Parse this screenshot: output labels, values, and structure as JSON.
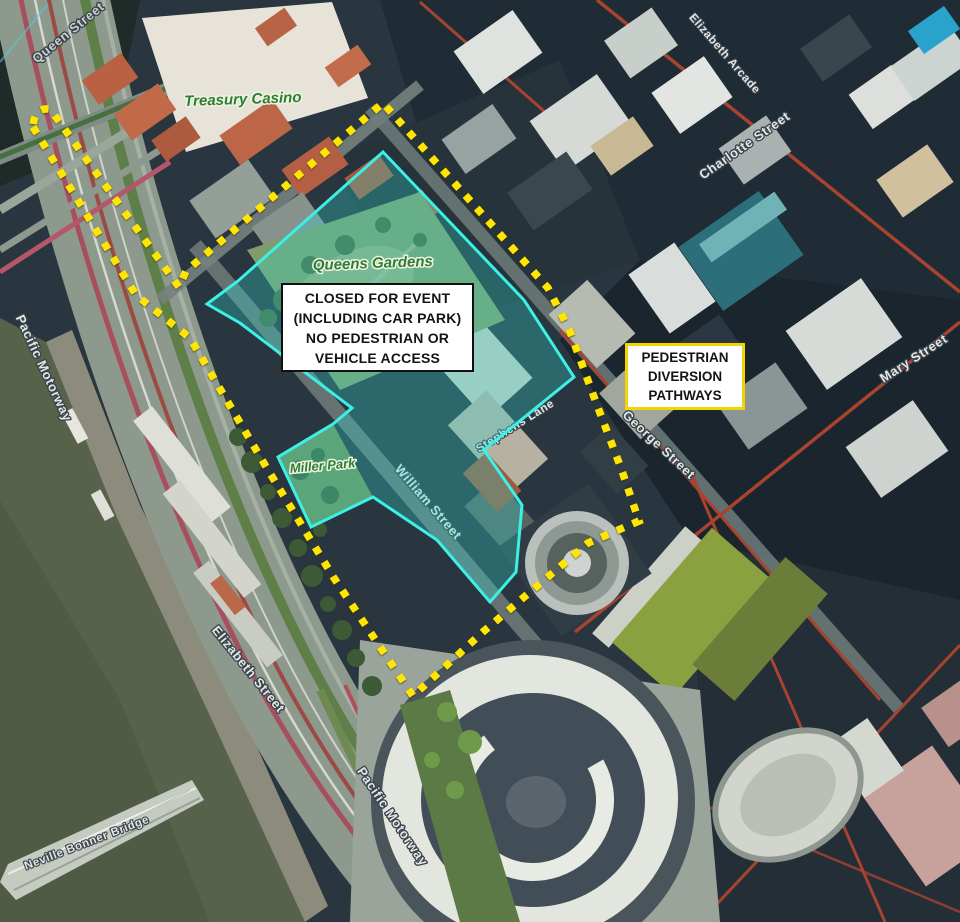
{
  "title": "Event closure aerial map",
  "annotations": {
    "closed_area": {
      "lines": [
        "CLOSED FOR EVENT",
        "(INCLUDING CAR PARK)",
        "NO PEDESTRIAN OR",
        "VEHICLE ACCESS"
      ],
      "border_color": "#101010",
      "fill_color": "#ffffff"
    },
    "diversion": {
      "lines": [
        "PEDESTRIAN",
        "DIVERSION",
        "PATHWAYS"
      ],
      "border_color": "#f2d400",
      "fill_color": "#ffffff"
    },
    "closed_overlay_color": "#3cf0e6",
    "diversion_path_color": "#ffe600"
  },
  "places": {
    "treasury_casino": "Treasury Casino",
    "queens_gardens": "Queens Gardens",
    "miller_park": "Miller Park"
  },
  "streets": {
    "queen_street": "Queen Street",
    "pacific_motorway_upper": "Pacific Motorway",
    "pacific_motorway_lower": "Pacific Motorway",
    "elizabeth_street": "Elizabeth Street",
    "william_street": "William Street",
    "stephens_lane": "Stephens Lane",
    "elizabeth_arcade": "Elizabeth Arcade",
    "charlotte_street": "Charlotte Street",
    "george_street": "George Street",
    "mary_street": "Mary Street",
    "neville_bonner_bridge": "Neville Bonner Bridge"
  }
}
